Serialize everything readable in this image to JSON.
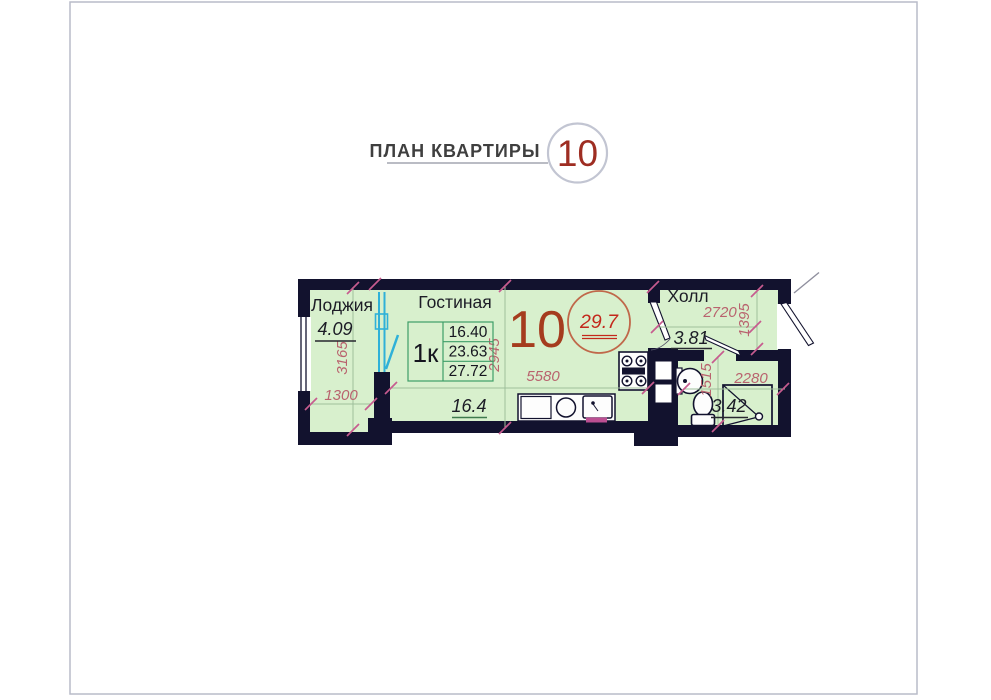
{
  "header": {
    "title": "ПЛАН КВАРТИРЫ",
    "apartment_number": "10"
  },
  "plan": {
    "apartment_number": "10",
    "total_area": "29.7",
    "loggia": {
      "name": "Лоджия",
      "area": "4.09",
      "width_mm": "1300",
      "depth_mm": "3165"
    },
    "living": {
      "name": "Гостиная",
      "area": "16.4",
      "width_mm": "5580",
      "depth_mm": "2945",
      "table": {
        "flat_type": "1к",
        "living_area": "16.40",
        "flat_area": "23.63",
        "total_area": "27.72"
      }
    },
    "hall": {
      "name": "Холл",
      "area": "3.81",
      "width_mm": "2720",
      "depth_mm": "1395"
    },
    "bathroom": {
      "area": "3.42",
      "width_mm": "2280",
      "depth_mm": "1515"
    }
  },
  "colors": {
    "wall": "#12122e",
    "floor": "#d8f0cd",
    "dimension_text": "#b9636e",
    "tick_pink": "#c75b8f",
    "accent_red": "#a53c1e",
    "circle_red": "#c3281c",
    "window_cyan": "#2fb1d8",
    "table_border": "#3e9e68",
    "page_border": "#b9bcc9"
  }
}
